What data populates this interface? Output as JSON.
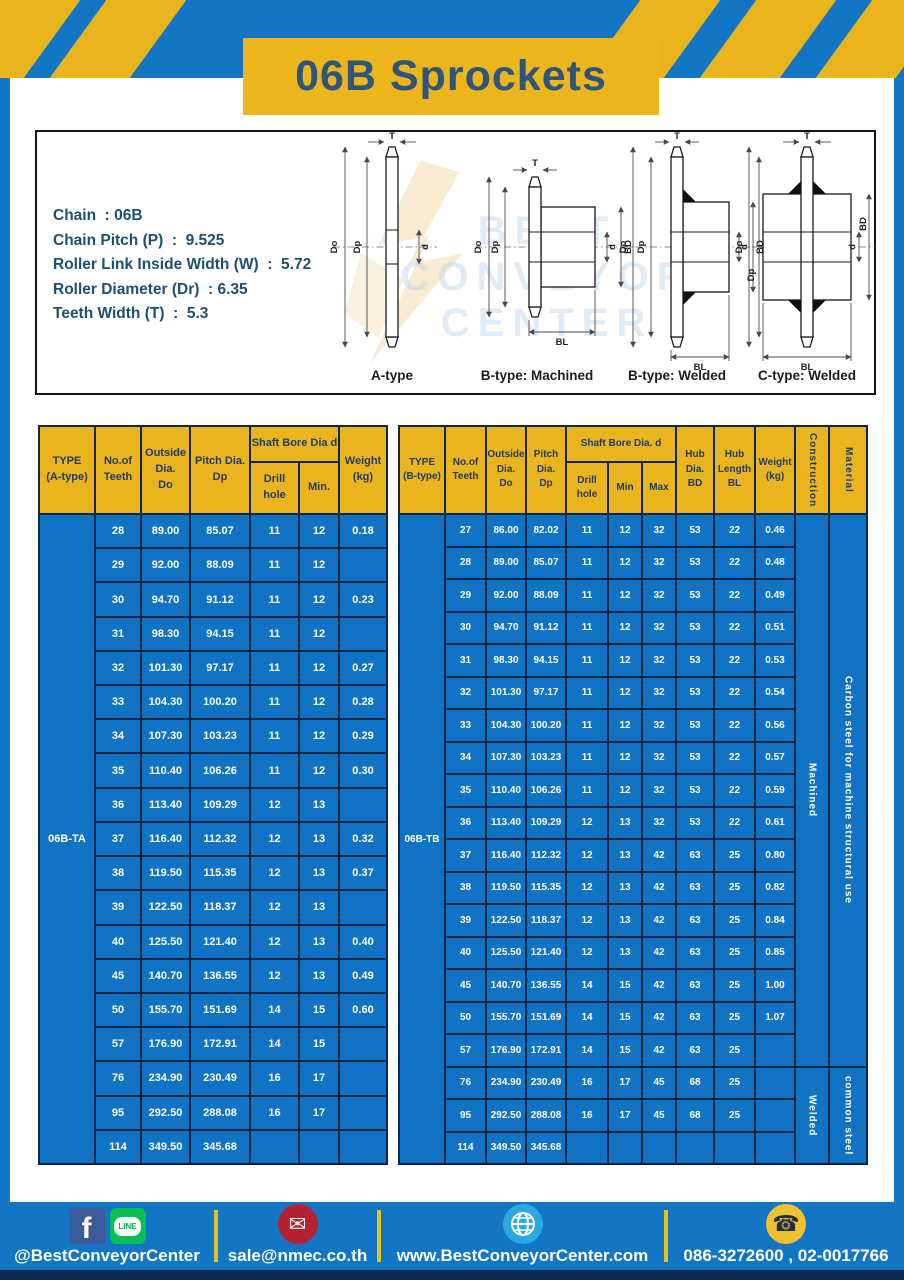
{
  "title": "06B Sprockets",
  "specs": {
    "lines": [
      "Chain  : 06B",
      "Chain Pitch (P)  :  9.525",
      "Roller Link Inside Width (W)  :  5.72",
      "Roller Diameter (Dr)  : 6.35",
      "Teeth Width (T)  :  5.3"
    ]
  },
  "diagrams": {
    "watermark": {
      "line1": "BEST",
      "line2": "CONVEYOR",
      "line3": "CENTER"
    },
    "captions": [
      "A-type",
      "B-type: Machined",
      "B-type: Welded",
      "C-type: Welded"
    ],
    "dim_labels": {
      "t": "T",
      "do": "Do",
      "dp": "Dp",
      "d": "d",
      "bd": "BD",
      "bl": "BL"
    }
  },
  "table_a": {
    "header": {
      "type": "TYPE\n(A-type)",
      "teeth": "No.of\nTeeth",
      "outside": "Outside\nDia.\nDo",
      "pitch": "Pitch Dia.\nDp",
      "shaft_bore": "Shaft Bore Dia d",
      "drill": "Drill hole",
      "min": "Min.",
      "weight": "Weight\n(kg)"
    },
    "type_value": "06B-TA",
    "rows": [
      [
        "28",
        "89.00",
        "85.07",
        "11",
        "12",
        "0.18"
      ],
      [
        "29",
        "92.00",
        "88.09",
        "11",
        "12",
        ""
      ],
      [
        "30",
        "94.70",
        "91.12",
        "11",
        "12",
        "0.23"
      ],
      [
        "31",
        "98.30",
        "94.15",
        "11",
        "12",
        ""
      ],
      [
        "32",
        "101.30",
        "97.17",
        "11",
        "12",
        "0.27"
      ],
      [
        "33",
        "104.30",
        "100.20",
        "11",
        "12",
        "0.28"
      ],
      [
        "34",
        "107.30",
        "103.23",
        "11",
        "12",
        "0.29"
      ],
      [
        "35",
        "110.40",
        "106.26",
        "11",
        "12",
        "0.30"
      ],
      [
        "36",
        "113.40",
        "109.29",
        "12",
        "13",
        ""
      ],
      [
        "37",
        "116.40",
        "112.32",
        "12",
        "13",
        "0.32"
      ],
      [
        "38",
        "119.50",
        "115.35",
        "12",
        "13",
        "0.37"
      ],
      [
        "39",
        "122.50",
        "118.37",
        "12",
        "13",
        ""
      ],
      [
        "40",
        "125.50",
        "121.40",
        "12",
        "13",
        "0.40"
      ],
      [
        "45",
        "140.70",
        "136.55",
        "12",
        "13",
        "0.49"
      ],
      [
        "50",
        "155.70",
        "151.69",
        "14",
        "15",
        "0.60"
      ],
      [
        "57",
        "176.90",
        "172.91",
        "14",
        "15",
        ""
      ],
      [
        "76",
        "234.90",
        "230.49",
        "16",
        "17",
        ""
      ],
      [
        "95",
        "292.50",
        "288.08",
        "16",
        "17",
        ""
      ],
      [
        "114",
        "349.50",
        "345.68",
        "",
        "",
        ""
      ]
    ]
  },
  "table_b": {
    "header": {
      "type": "TYPE\n(B-type)",
      "teeth": "No.of\nTeeth",
      "outside": "Outside\nDia.\nDo",
      "pitch": "Pitch\nDia.\nDp",
      "shaft_bore": "Shaft Bore Dia.  d",
      "drill": "Drill hole",
      "min": "Min",
      "max": "Max",
      "hub_dia": "Hub\nDia.\nBD",
      "hub_len": "Hub\nLength\nBL",
      "weight": "Weight\n(kg)",
      "construction": "Construction",
      "material": "Material"
    },
    "type_value": "06B-TB",
    "construction_groups": [
      {
        "label": "Machined",
        "rows": 17
      },
      {
        "label": "Welded",
        "rows": 3
      }
    ],
    "material_groups": [
      {
        "label": "Carbon steel for machine structural use",
        "rows": 17
      },
      {
        "label": "common steel",
        "rows": 3
      }
    ],
    "rows": [
      [
        "27",
        "86.00",
        "82.02",
        "11",
        "12",
        "32",
        "53",
        "22",
        "0.46"
      ],
      [
        "28",
        "89.00",
        "85.07",
        "11",
        "12",
        "32",
        "53",
        "22",
        "0.48"
      ],
      [
        "29",
        "92.00",
        "88.09",
        "11",
        "12",
        "32",
        "53",
        "22",
        "0.49"
      ],
      [
        "30",
        "94.70",
        "91.12",
        "11",
        "12",
        "32",
        "53",
        "22",
        "0.51"
      ],
      [
        "31",
        "98.30",
        "94.15",
        "11",
        "12",
        "32",
        "53",
        "22",
        "0.53"
      ],
      [
        "32",
        "101.30",
        "97.17",
        "11",
        "12",
        "32",
        "53",
        "22",
        "0.54"
      ],
      [
        "33",
        "104.30",
        "100.20",
        "11",
        "12",
        "32",
        "53",
        "22",
        "0.56"
      ],
      [
        "34",
        "107.30",
        "103.23",
        "11",
        "12",
        "32",
        "53",
        "22",
        "0.57"
      ],
      [
        "35",
        "110.40",
        "106.26",
        "11",
        "12",
        "32",
        "53",
        "22",
        "0.59"
      ],
      [
        "36",
        "113.40",
        "109.29",
        "12",
        "13",
        "32",
        "53",
        "22",
        "0.61"
      ],
      [
        "37",
        "116.40",
        "112.32",
        "12",
        "13",
        "42",
        "63",
        "25",
        "0.80"
      ],
      [
        "38",
        "119.50",
        "115.35",
        "12",
        "13",
        "42",
        "63",
        "25",
        "0.82"
      ],
      [
        "39",
        "122.50",
        "118.37",
        "12",
        "13",
        "42",
        "63",
        "25",
        "0.84"
      ],
      [
        "40",
        "125.50",
        "121.40",
        "12",
        "13",
        "42",
        "63",
        "25",
        "0.85"
      ],
      [
        "45",
        "140.70",
        "136.55",
        "14",
        "15",
        "42",
        "63",
        "25",
        "1.00"
      ],
      [
        "50",
        "155.70",
        "151.69",
        "14",
        "15",
        "42",
        "63",
        "25",
        "1.07"
      ],
      [
        "57",
        "176.90",
        "172.91",
        "14",
        "15",
        "42",
        "63",
        "25",
        ""
      ],
      [
        "76",
        "234.90",
        "230.49",
        "16",
        "17",
        "45",
        "68",
        "25",
        ""
      ],
      [
        "95",
        "292.50",
        "288.08",
        "16",
        "17",
        "45",
        "68",
        "25",
        ""
      ],
      [
        "114",
        "349.50",
        "345.68",
        "",
        "",
        "",
        "",
        "",
        ""
      ]
    ]
  },
  "footer": {
    "social": "@BestConveyorCenter",
    "line_badge": "LINE",
    "facebook_glyph": "f",
    "email": "sale@nmec.co.th",
    "website": "www.BestConveyorCenter.com",
    "phone": "086-3272600 , 02-0017766"
  },
  "colors": {
    "primary_blue": "#1276c5",
    "table_blue": "#1173c4",
    "accent_yellow": "#eab41f",
    "navy_border": "#0f2742",
    "title_navy": "#2d567c"
  }
}
